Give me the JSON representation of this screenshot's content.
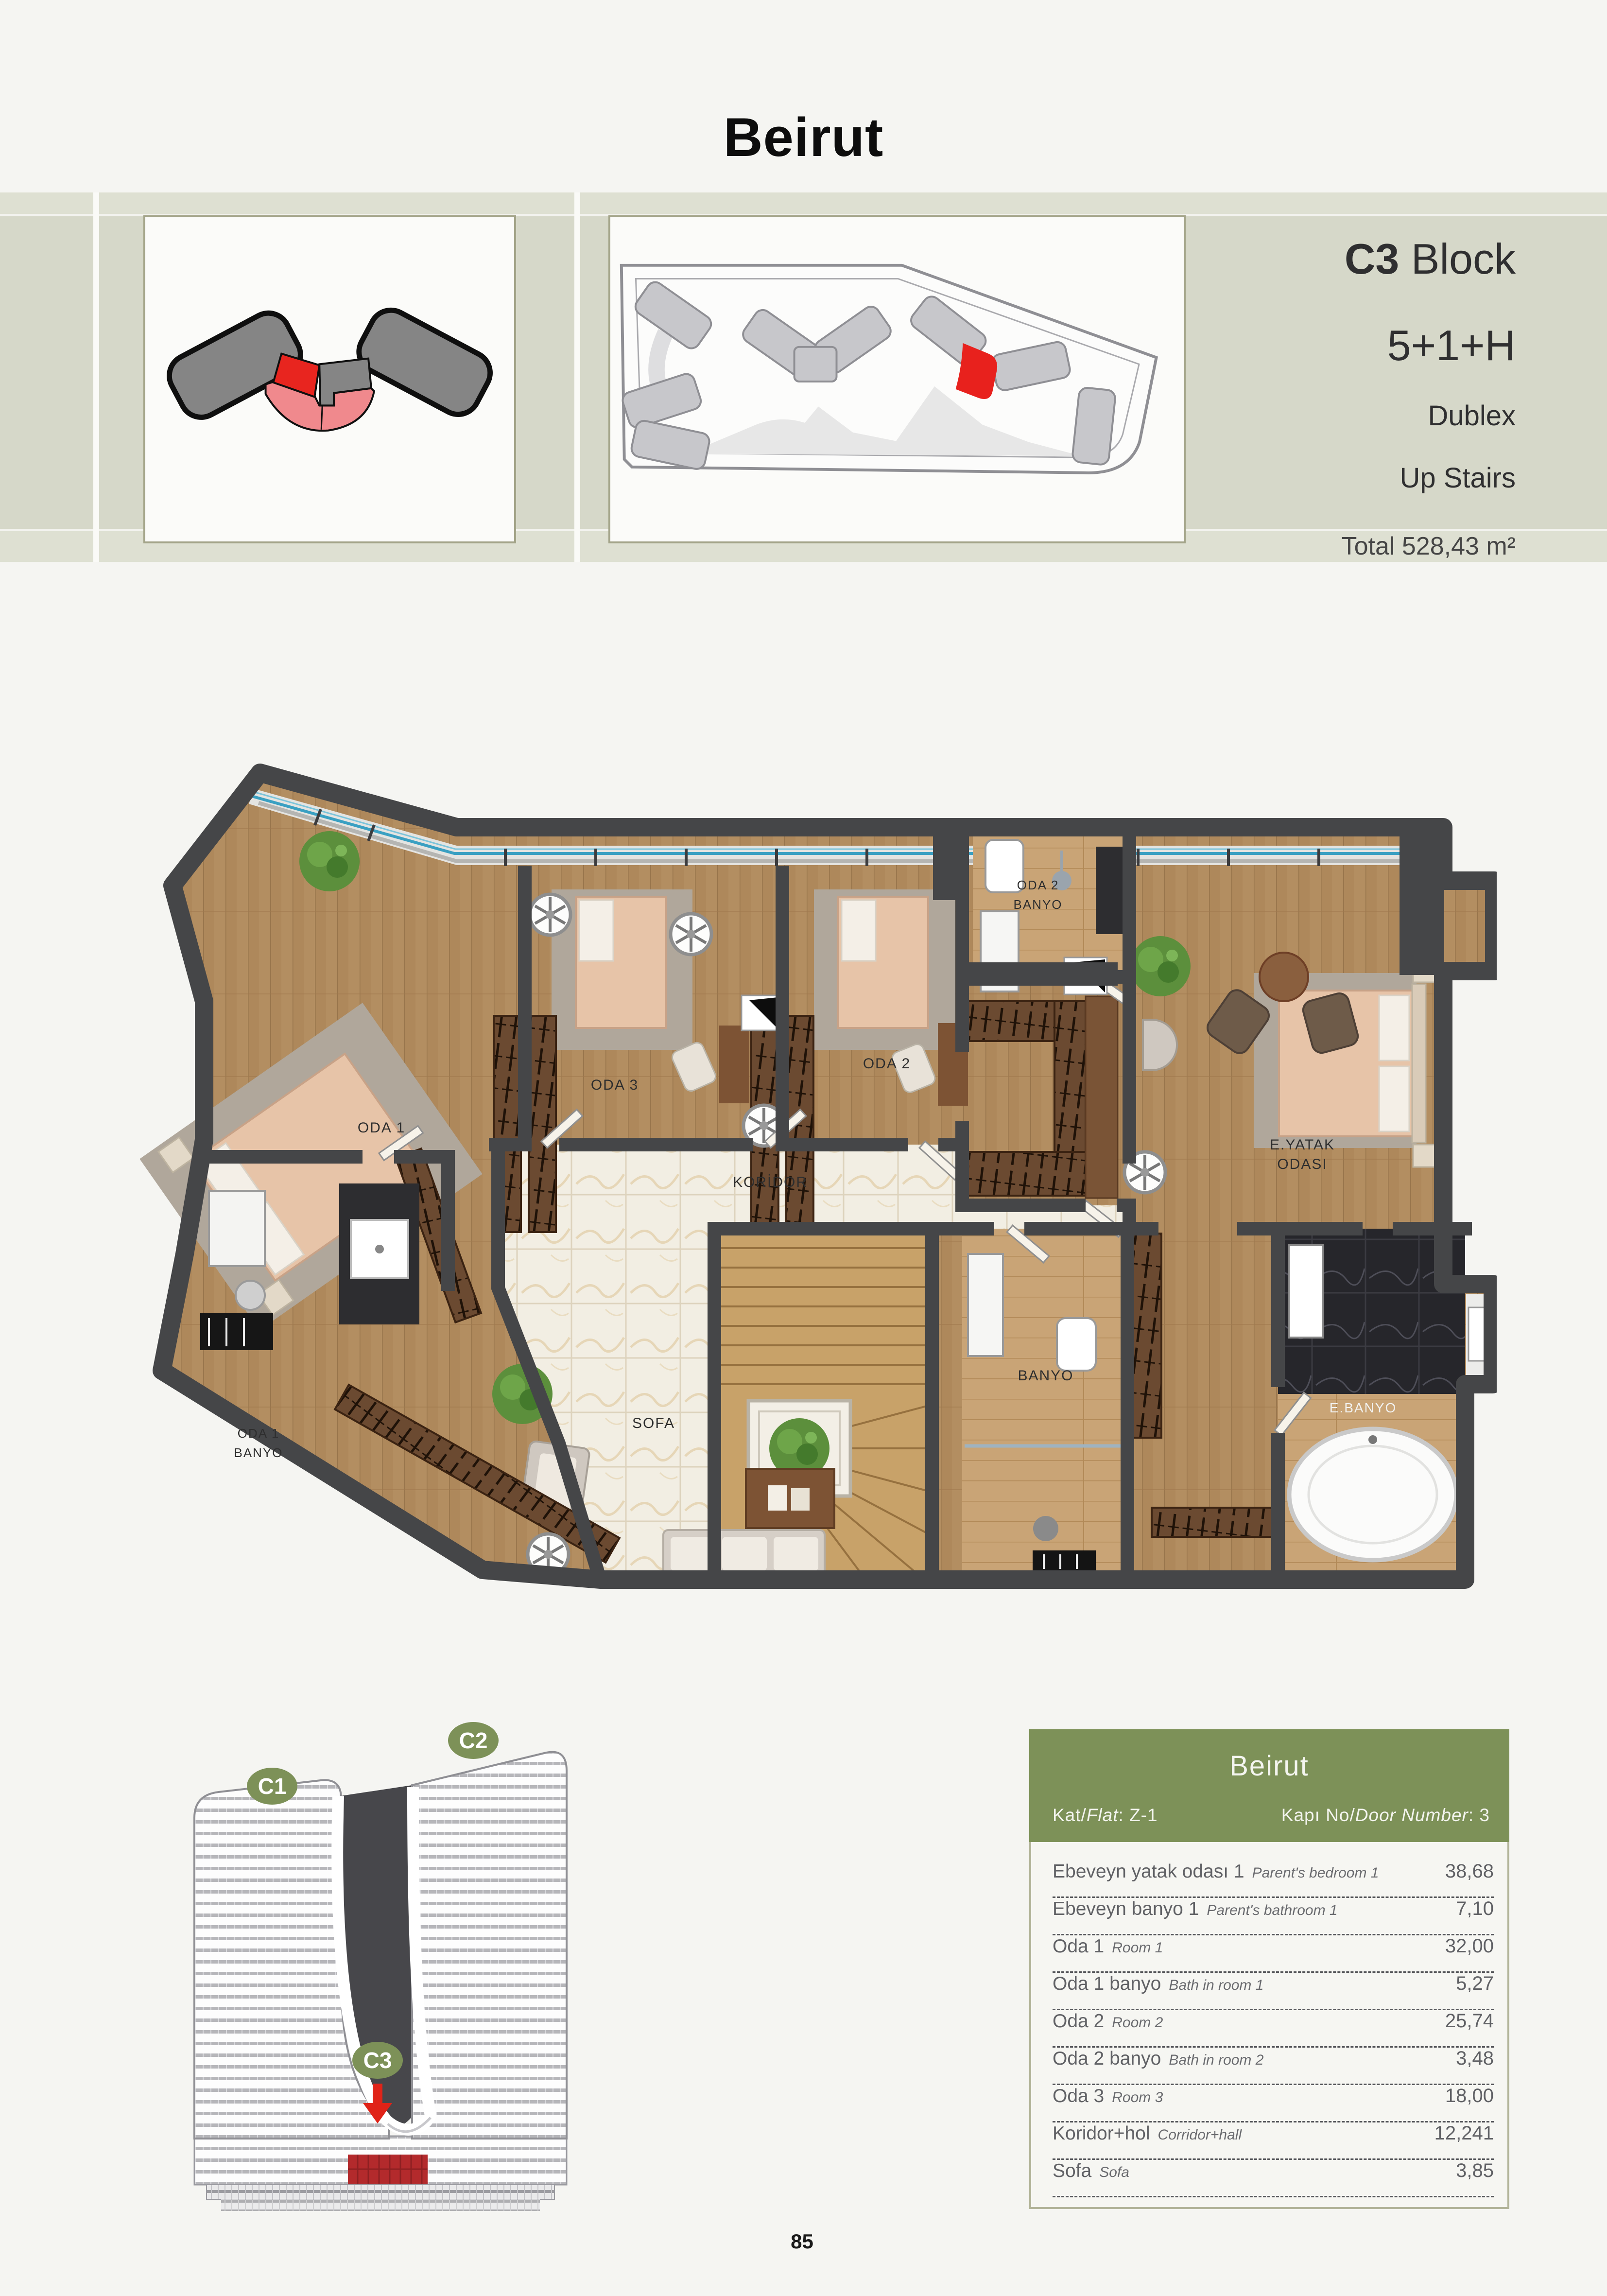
{
  "header": {
    "title": "Beirut",
    "block_bold": "C3",
    "block_rest": " Block",
    "unit_type": "5+1+H",
    "line3": "Dublex",
    "line4": "Up Stairs",
    "total": "Total 528,43 m²"
  },
  "plan": {
    "labels": {
      "oda1": "ODA 1",
      "oda3": "ODA 3",
      "oda2": "ODA 2",
      "oda2_banyo_1": "ODA 2",
      "oda2_banyo_2": "BANYO",
      "eyatak_1": "E.YATAK",
      "eyatak_2": "ODASI",
      "oda1_banyo_1": "ODA 1",
      "oda1_banyo_2": "BANYO",
      "koridor": "KORİDOR",
      "sofa": "SOFA",
      "banyo": "BANYO",
      "ebanyo": "E.BANYO"
    }
  },
  "building": {
    "badges": [
      "C1",
      "C2",
      "C3"
    ]
  },
  "table": {
    "title": "Beirut",
    "flat_label": "Kat/",
    "flat_label_en": "Flat",
    "flat_sep": ":  ",
    "flat_value": "Z-1",
    "door_label": "Kapı No/",
    "door_label_en": "Door Number",
    "door_sep": ":  ",
    "door_value": "3",
    "rows": [
      {
        "tr": "Ebeveyn yatak odası 1",
        "en": "Parent's bedroom 1",
        "area": "38,68"
      },
      {
        "tr": "Ebeveyn banyo 1",
        "en": "Parent's bathroom 1",
        "area": "7,10"
      },
      {
        "tr": "Oda 1",
        "en": "Room 1",
        "area": "32,00"
      },
      {
        "tr": "Oda 1 banyo",
        "en": "Bath in room 1",
        "area": "5,27"
      },
      {
        "tr": "Oda 2",
        "en": "Room 2",
        "area": "25,74"
      },
      {
        "tr": "Oda 2 banyo",
        "en": "Bath in room 2",
        "area": "3,48"
      },
      {
        "tr": "Oda 3",
        "en": "Room 3",
        "area": "18,00"
      },
      {
        "tr": "Koridor+hol",
        "en": "Corridor+hall",
        "area": "12,241"
      },
      {
        "tr": "Sofa",
        "en": "Sofa",
        "area": "3,85"
      }
    ]
  },
  "footer": {
    "page_number": "85"
  },
  "colors": {
    "accent_green": "#7d9158",
    "highlight_red": "#e8211d",
    "band": "#d6d8c9",
    "wall": "#454648"
  }
}
